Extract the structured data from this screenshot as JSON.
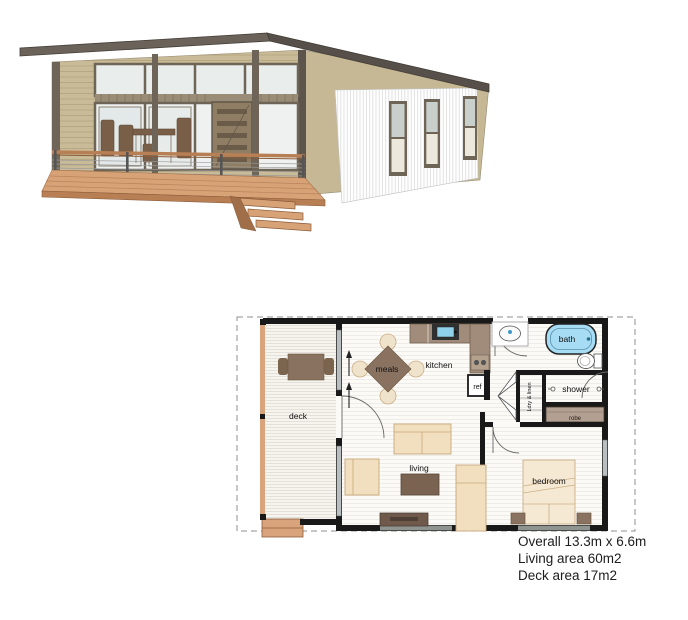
{
  "floor_plan": {
    "labels": {
      "deck": "deck",
      "meals": "meals",
      "kitchen": "kitchen",
      "living": "living",
      "bedroom": "bedroom",
      "bath": "bath",
      "shower": "shower",
      "ref": "ref",
      "robe": "robe",
      "laundry": "Ldry & linen"
    },
    "colors": {
      "bath_fill": "#a6dcf4",
      "wall": "#191919",
      "counter": "#a18c7b",
      "furniture_light": "#f2dfbf",
      "furniture_dark": "#7b6352",
      "deck_wood": "#d9a47c",
      "robe_fill": "#b3a093"
    }
  },
  "specs": {
    "overall": "Overall 13.3m x 6.6m",
    "living_area": "Living area 60m2",
    "deck_area": "Deck area 17m2"
  },
  "render": {
    "colors": {
      "roof": "#5f574b",
      "siding_tan": "#c9bb97",
      "cladding_white": "#ffffff",
      "deck_timber": "#d8a277",
      "trim": "#6e6457"
    }
  }
}
